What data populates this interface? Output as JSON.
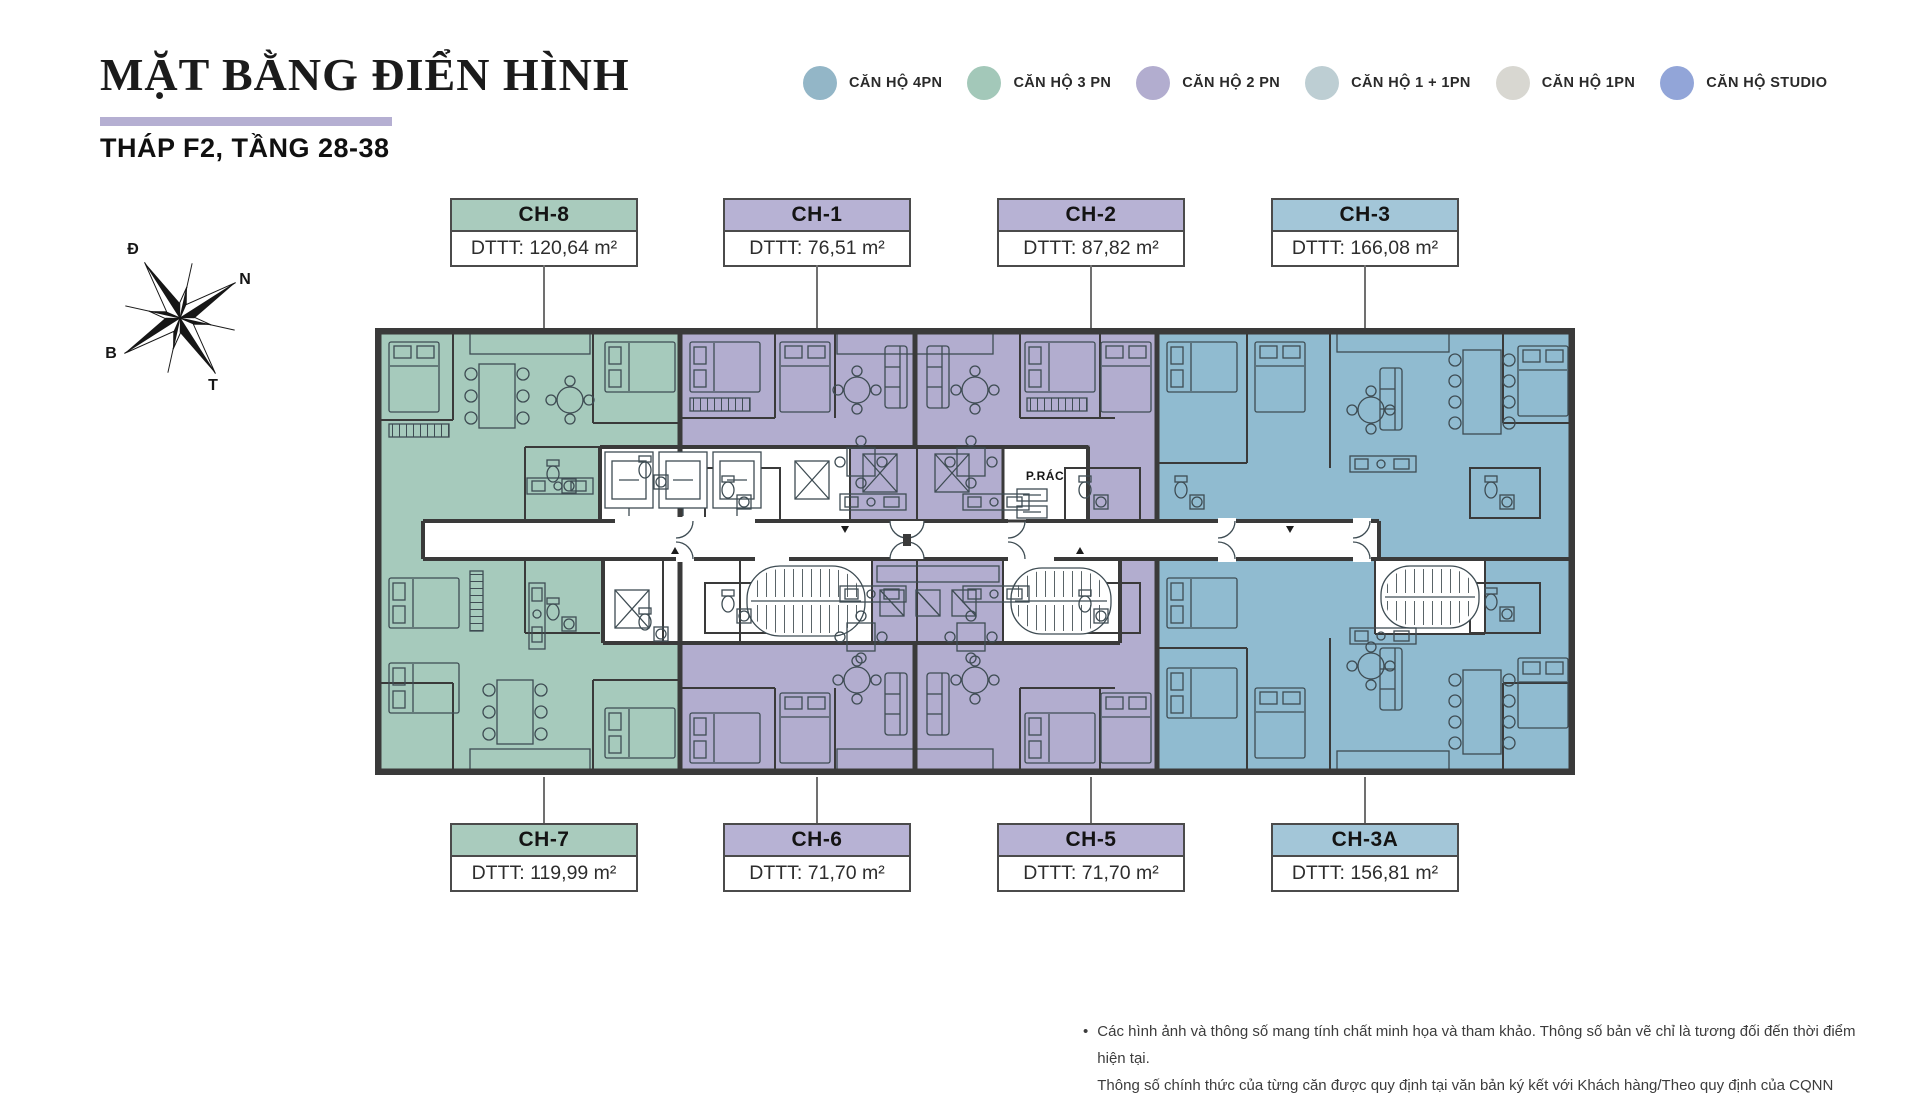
{
  "header": {
    "title": "MẶT BẰNG ĐIỂN HÌNH",
    "subtitle": "THÁP F2, TẦNG 28-38"
  },
  "legend": {
    "items": [
      {
        "label": "CĂN HỘ 4PN",
        "color": "#93b6c7"
      },
      {
        "label": "CĂN HỘ 3 PN",
        "color": "#a3c8b9"
      },
      {
        "label": "CĂN HỘ 2 PN",
        "color": "#b2adcf"
      },
      {
        "label": "CĂN HỘ 1 + 1PN",
        "color": "#bdced3"
      },
      {
        "label": "CĂN HỘ 1PN",
        "color": "#d8d7d1"
      },
      {
        "label": "CĂN HỘ STUDIO",
        "color": "#92a5d8"
      }
    ]
  },
  "compass": {
    "d": "Đ",
    "n": "N",
    "b": "B",
    "t": "T"
  },
  "units": {
    "top": [
      {
        "id": "CH-8",
        "area": "DTTT: 120,64 m²",
        "color": "#a9cbbd"
      },
      {
        "id": "CH-1",
        "area": "DTTT: 76,51 m²",
        "color": "#b7b2d4"
      },
      {
        "id": "CH-2",
        "area": "DTTT: 87,82 m²",
        "color": "#b7b2d4"
      },
      {
        "id": "CH-3",
        "area": "DTTT: 166,08 m²",
        "color": "#a3c6d8"
      }
    ],
    "bottom": [
      {
        "id": "CH-7",
        "area": "DTTT: 119,99 m²",
        "color": "#a9cbbd"
      },
      {
        "id": "CH-6",
        "area": "DTTT: 71,70 m²",
        "color": "#b7b2d4"
      },
      {
        "id": "CH-5",
        "area": "DTTT: 71,70 m²",
        "color": "#b7b2d4"
      },
      {
        "id": "CH-3A",
        "area": "DTTT: 156,81 m²",
        "color": "#a3c6d8"
      }
    ]
  },
  "plan": {
    "trash_label": "P.RÁC",
    "colors": {
      "green": "#a6cabc",
      "purple": "#b2adcf",
      "blue": "#90bbd0"
    }
  },
  "footer": {
    "bullet": "•",
    "lines": [
      "Các hình ảnh và thông số mang tính chất minh họa và tham khảo. Thông số bản vẽ chỉ là tương đối đến thời điểm hiện tại.",
      "Thông số chính thức của từng căn được quy định tại văn bản ký kết với Khách hàng/Theo quy định của CQNN"
    ]
  }
}
